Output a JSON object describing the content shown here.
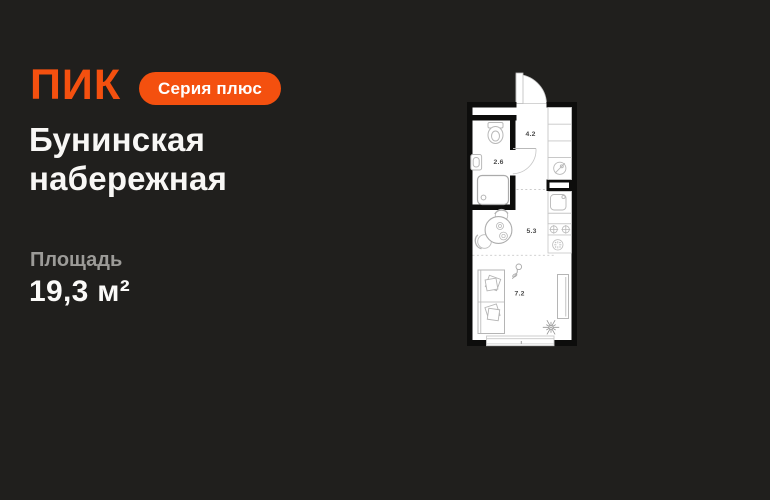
{
  "card": {
    "brand_logo": "ПИК",
    "series_badge": "Серия плюс",
    "title_line1": "Бунинская",
    "title_line2": "набережная",
    "area_label": "Площадь",
    "area_value": "19,3 м²"
  },
  "colors": {
    "background": "#201F1D",
    "accent_orange": "#F4500F",
    "text_primary": "#F8F7F5",
    "text_secondary": "#9C9B98",
    "plan_walls": "#0D0D0C",
    "plan_floor": "#FFFFFF"
  },
  "floorplan": {
    "rooms": [
      {
        "name": "bathroom",
        "area": "2.6"
      },
      {
        "name": "hallway",
        "area": "4.2"
      },
      {
        "name": "kitchen-dining",
        "area": "5.3"
      },
      {
        "name": "living-room",
        "area": "7.2"
      }
    ]
  }
}
